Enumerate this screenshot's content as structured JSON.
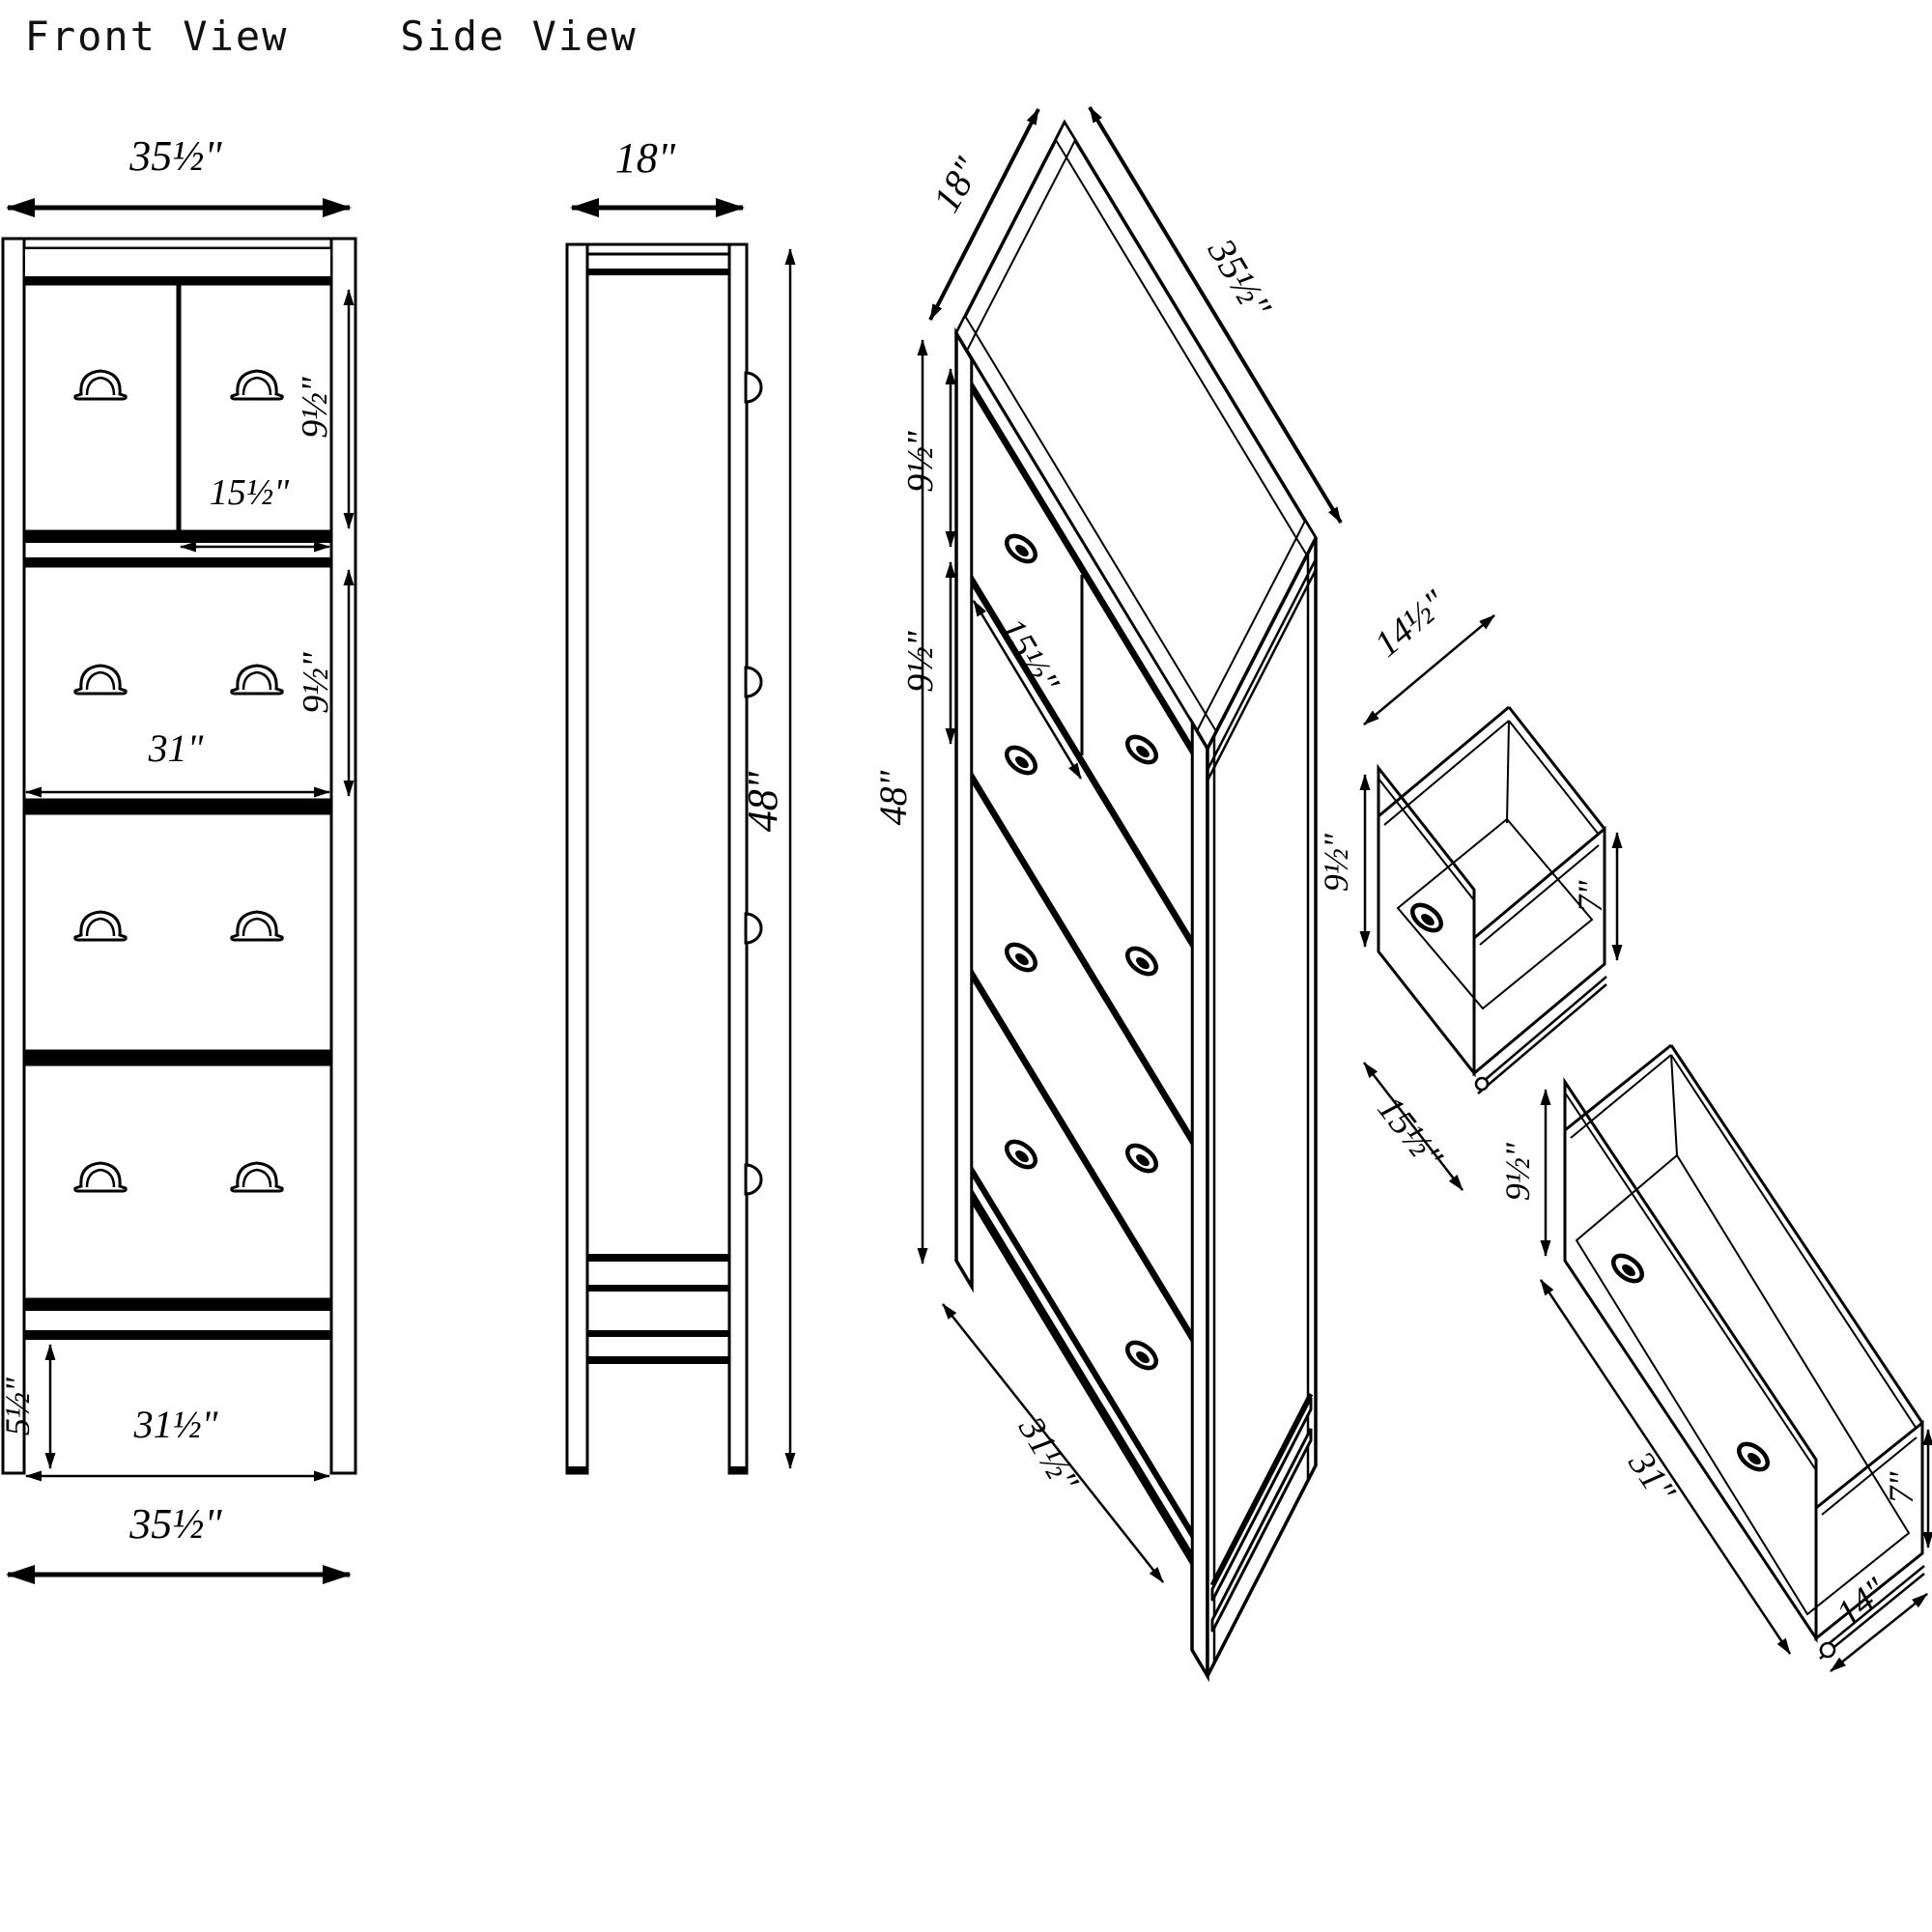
{
  "views": {
    "front": {
      "title": "Front View",
      "dims": {
        "overall_width_top": "35½\"",
        "top_drawer_height": "9½\"",
        "drawer_width": "15½\"",
        "middle_drawer_height": "9½\"",
        "opening_width": "31\"",
        "base_height": "5½\"",
        "base_opening_width": "31½\"",
        "overall_width_bottom": "35½\""
      }
    },
    "side": {
      "title": "Side View",
      "dims": {
        "depth": "18\"",
        "overall_height": "48\""
      }
    },
    "isometric": {
      "dims": {
        "depth": "18\"",
        "overall_width": "35½\"",
        "top_drawer_height": "9½\"",
        "second_drawer_height": "9½\"",
        "overall_height": "48\"",
        "top_drawer_width": "15½\"",
        "base_opening_width": "31½\""
      }
    },
    "small_drawer": {
      "dims": {
        "depth": "14½\"",
        "front_height": "9½\"",
        "side_height": "7\"",
        "width": "15½\""
      }
    },
    "large_drawer": {
      "dims": {
        "front_height": "9½\"",
        "width": "31\"",
        "depth": "14\"",
        "side_height": "7\""
      }
    }
  }
}
